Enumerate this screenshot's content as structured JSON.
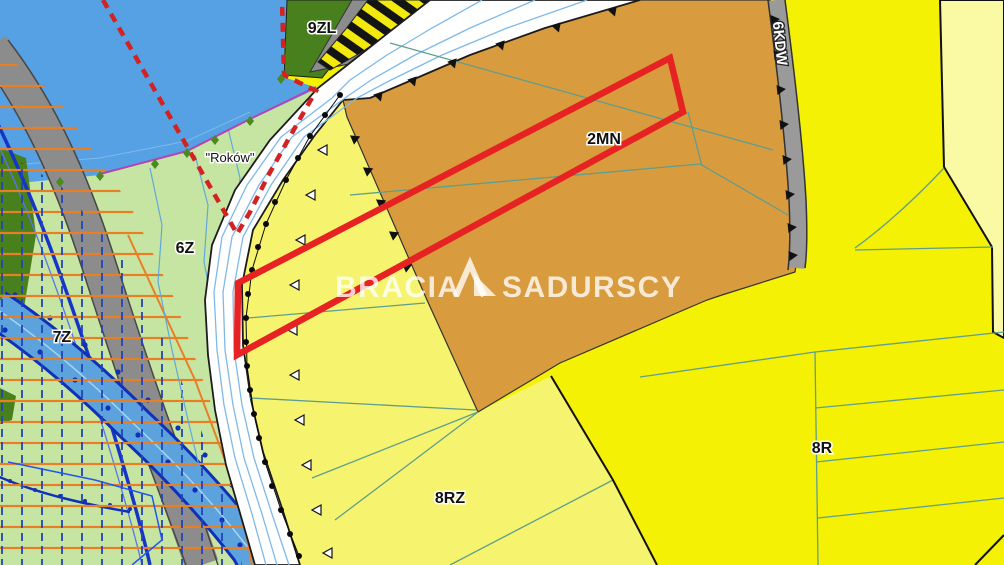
{
  "map": {
    "title": "zoning plan extract",
    "zones": {
      "residential": {
        "code": "2MN",
        "color": "#D89B3E"
      },
      "greenery_east": {
        "code": "6Z",
        "color": "#C7E5A2"
      },
      "greenery_west": {
        "code": "7Z",
        "color": "#C7E5A2"
      },
      "meadow": {
        "code": "8RZ",
        "color": "#F6F36E"
      },
      "farmland": {
        "code": "8R",
        "color": "#F4F105"
      },
      "forest": {
        "code": "9ZL",
        "color": "#47801D"
      },
      "internal_road": {
        "code": "6KDW",
        "color": "#9A9A9A"
      }
    },
    "place_name": "\"Roków\"",
    "watermark": {
      "brand_part_1": "BRACIA",
      "brand_part_2": "SADURSCY"
    },
    "colors": {
      "water": "#55A1E4",
      "corridor_white": "#FFFFFF",
      "corridor_blue_lines": "#7FB9E8",
      "parcel_outline_red": "#E62222",
      "boundary_dashed_red": "#D22222",
      "hatch_orange": "#E87F25",
      "hatch_blue_dash": "#2143B8",
      "river_fill": "#5CA3DD",
      "river_edge_blue": "#1030B8",
      "thick_blue_line": "#1535C8",
      "parcel_teal_lines": "#5F9E8F",
      "magenta_boundary": "#B544B5",
      "pale_corner_yellow": "#FAF9A4",
      "road_gray_band": "#8C8C8C",
      "black_boundary": "#111111"
    }
  }
}
